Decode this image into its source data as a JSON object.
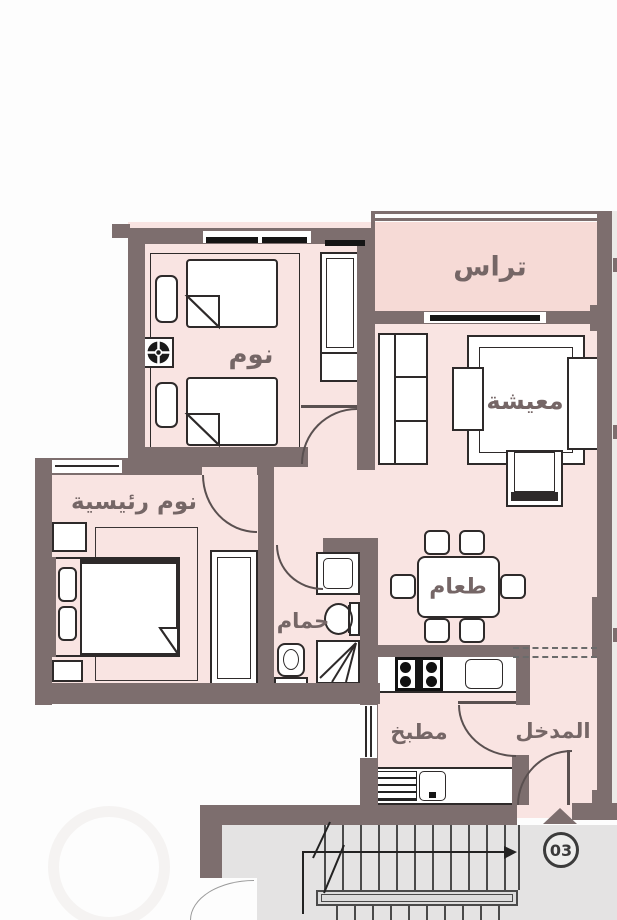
{
  "rooms": {
    "bedroom": {
      "label": "نوم"
    },
    "terrace": {
      "label": "تراس"
    },
    "living": {
      "label": "معيشة"
    },
    "master_bedroom": {
      "label": "نوم رئيسية"
    },
    "dining": {
      "label": "طعام"
    },
    "bathroom": {
      "label": "حمام"
    },
    "kitchen": {
      "label": "مطبخ"
    },
    "entrance": {
      "label": "المدخل"
    }
  },
  "badge": {
    "label": "03"
  },
  "colors": {
    "wall": "#7d6e6e",
    "floor": "#f9e4e2",
    "terrace_floor": "#f6dad6",
    "common_floor": "#e4e3e3",
    "furniture_outline": "#2e2a2a",
    "label_text": "#756666"
  }
}
